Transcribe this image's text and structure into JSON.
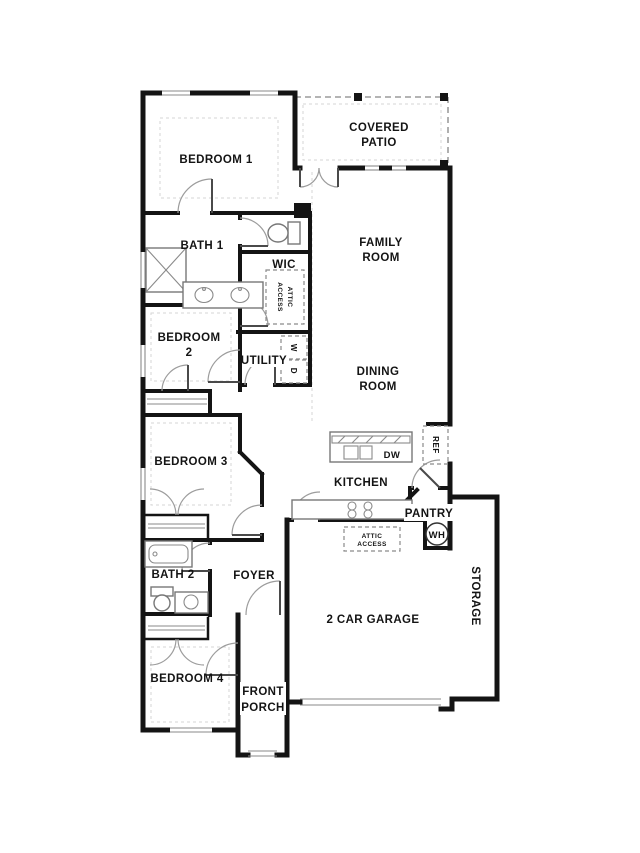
{
  "plan": {
    "labels": {
      "bedroom1": "BEDROOM 1",
      "covered_patio_l1": "COVERED",
      "covered_patio_l2": "PATIO",
      "family_room_l1": "FAMILY",
      "family_room_l2": "ROOM",
      "bath1": "BATH 1",
      "wic": "WIC",
      "wic_attic_l1": "ATTIC",
      "wic_attic_l2": "ACCESS",
      "bedroom2_l1": "BEDROOM",
      "bedroom2_l2": "2",
      "utility": "UTILITY",
      "washer": "W",
      "dryer": "D",
      "dining_l1": "DINING",
      "dining_l2": "ROOM",
      "bedroom3": "BEDROOM 3",
      "ref": "REF",
      "dw": "DW",
      "kitchen": "KITCHEN",
      "pantry": "PANTRY",
      "wh": "WH",
      "garage_attic_l1": "ATTIC",
      "garage_attic_l2": "ACCESS",
      "bath2": "BATH 2",
      "foyer": "FOYER",
      "garage": "2 CAR GARAGE",
      "storage": "STORAGE",
      "bedroom4": "BEDROOM 4",
      "front_porch_l1": "FRONT",
      "front_porch_l2": "PORCH"
    },
    "colors": {
      "wall": "#141414",
      "fixture": "#777777",
      "floor_line": "#d6d6d6",
      "background": "#ffffff",
      "text": "#141414"
    }
  }
}
